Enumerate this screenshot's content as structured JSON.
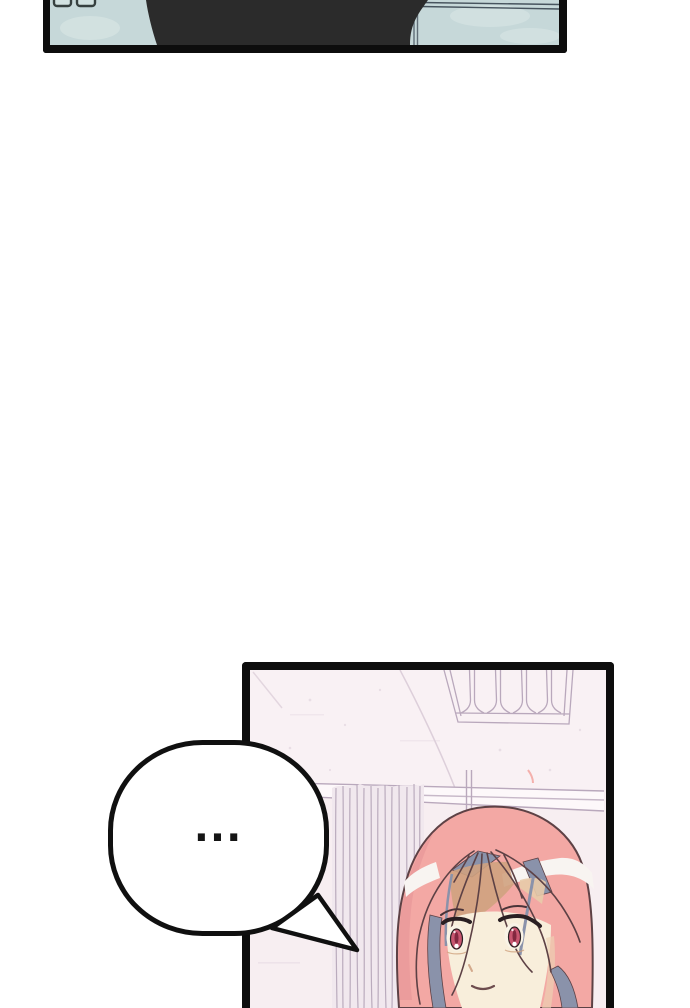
{
  "viewer": {
    "background": "#ffffff",
    "panel_border": "#0d0d0d"
  },
  "speech_bubble": {
    "text": "...",
    "fill": "#ffffff",
    "outline": "#101010"
  },
  "panels": {
    "top": {
      "background": "#c6d8d9",
      "cloud": "#dde9e8",
      "silhouette": "#2b2b2b",
      "window_fill": "#d2e2e1",
      "window_outline": "#36403f",
      "trim_line": "#47545e"
    },
    "bottom": {
      "background": "#f9f1f4",
      "wall": "#f7eef1",
      "rail_fill": "#fdf8fa",
      "line": "#b9a8bc",
      "faint_line": "#ddcfda",
      "curtain_fill": "#f1e8ee",
      "curtain_line": "#b5a5b8"
    }
  },
  "character": {
    "hair": "#f3a8a4",
    "hair_shade": "#e9999a",
    "hair_outline": "#5d4145",
    "hair_highlight": "#f8f4f1",
    "hair_underlayer": "#8a92aa",
    "skin": "#f8eedb",
    "shadow_tan": "#cfa27f",
    "shadow_tan_light": "#e8cbaa",
    "eye_white": "#f9f3e6",
    "eye_iris": "#c85670",
    "eye_pupil": "#822840",
    "lash": "#2a1f22",
    "brow": "#4a3338",
    "mouth": "#6d4c4e",
    "nose": "#d3a98c",
    "cheek_shade": "#ecd2b4"
  }
}
